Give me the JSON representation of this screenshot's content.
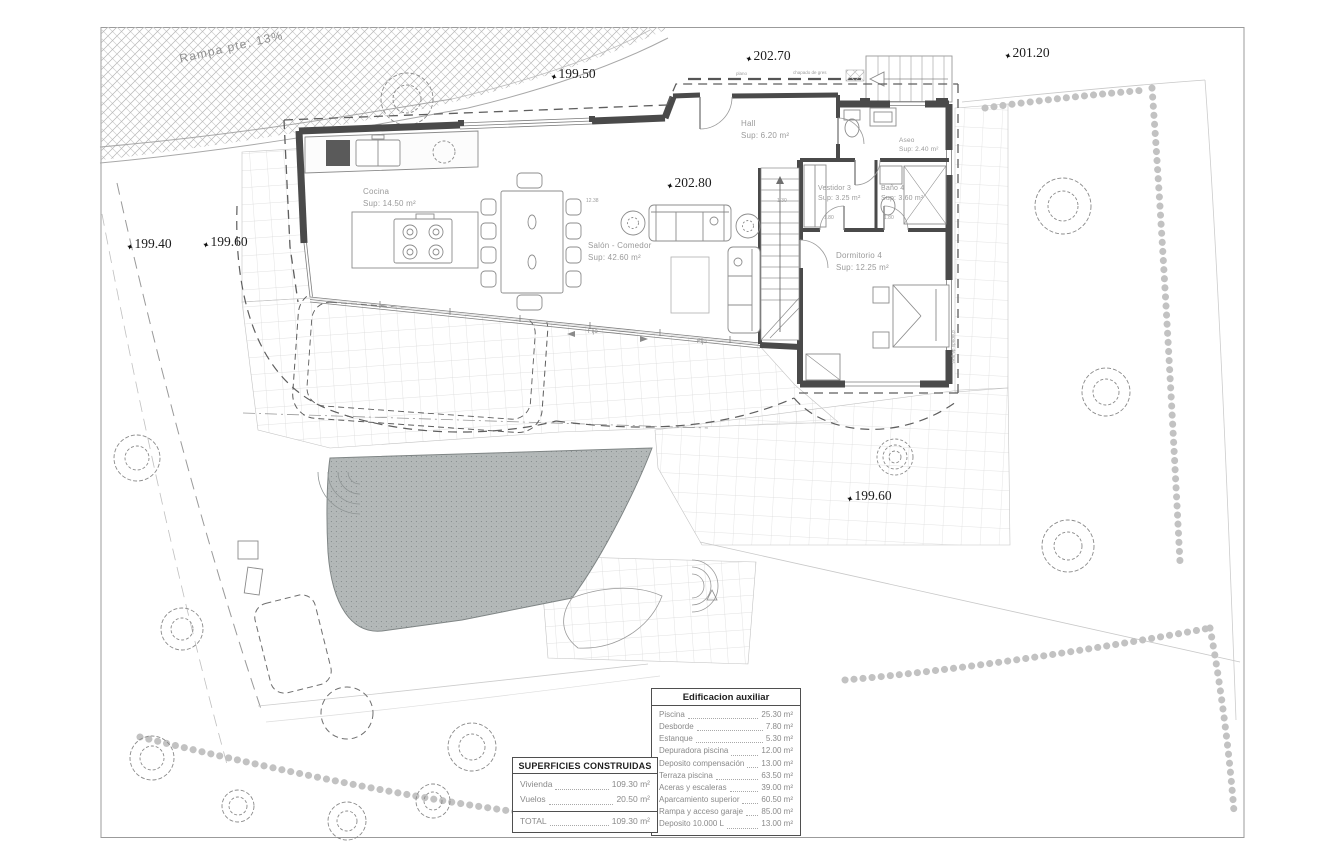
{
  "ramp": {
    "label": "Rampa pte: 13%"
  },
  "levels": {
    "l199_50": "199.50",
    "l202_70": "202.70",
    "l201_20": "201.20",
    "l199_40": "199.40",
    "l199_60_top": "199.60",
    "l202_80": "202.80",
    "l199_60_mid": "199.60"
  },
  "rooms": {
    "cocina": {
      "name": "Cocina",
      "area": "Sup: 14.50 m²"
    },
    "salon": {
      "name": "Salón - Comedor",
      "area": "Sup: 42.60 m²"
    },
    "hall": {
      "name": "Hall",
      "area": "Sup: 6.20 m²"
    },
    "aseo": {
      "name": "Aseo",
      "area": "Sup: 2.40 m²"
    },
    "vestidor": {
      "name": "Vestidor 3",
      "area": "Sup: 3.25 m²"
    },
    "bano": {
      "name": "Baño 4",
      "area": "Sup: 3.60 m²"
    },
    "dormitorio": {
      "name": "Dormitorio 4",
      "area": "Sup: 12.25 m²"
    }
  },
  "window_labels": {
    "fijo1": "Fijo",
    "fijo2": "Fijo"
  },
  "finish_labels": {
    "plano": "plano",
    "gres_top": "chapado de gres",
    "gres_right": "chapado de gres"
  },
  "dimensions": {
    "d1": "12.38",
    "d2": "1.30",
    "d3": "1.80",
    "d4": "1.80"
  },
  "tables": {
    "superficies": {
      "title": "SUPERFICIES CONSTRUIDAS",
      "rows": [
        {
          "label": "Vivienda",
          "value": "109.30 m²"
        },
        {
          "label": "Vuelos",
          "value": "20.50 m²"
        }
      ],
      "total": {
        "label": "TOTAL",
        "value": "109.30 m²"
      }
    },
    "auxiliar": {
      "title": "Edificacion auxiliar",
      "rows": [
        {
          "label": "Piscina",
          "value": "25.30 m²"
        },
        {
          "label": "Desborde",
          "value": "7.80 m²"
        },
        {
          "label": "Estanque",
          "value": "5.30 m²"
        },
        {
          "label": "Depuradora piscina",
          "value": "12.00 m²"
        },
        {
          "label": "Deposito compensación",
          "value": "13.00 m²"
        },
        {
          "label": "Terraza piscina",
          "value": "63.50 m²"
        },
        {
          "label": "Aceras y escaleras",
          "value": "39.00 m²"
        },
        {
          "label": "Aparcamiento superior",
          "value": "60.50 m²"
        },
        {
          "label": "Rampa y acceso garaje",
          "value": "85.00 m²"
        },
        {
          "label": "Deposito 10.000 L",
          "value": "13.00 m²"
        }
      ]
    }
  },
  "colors": {
    "wall": "#4a4a4a",
    "line": "#8c8c8c",
    "grid": "#d7d7d7",
    "pool": "#b3b8b8",
    "text": "#9a9a9a"
  }
}
